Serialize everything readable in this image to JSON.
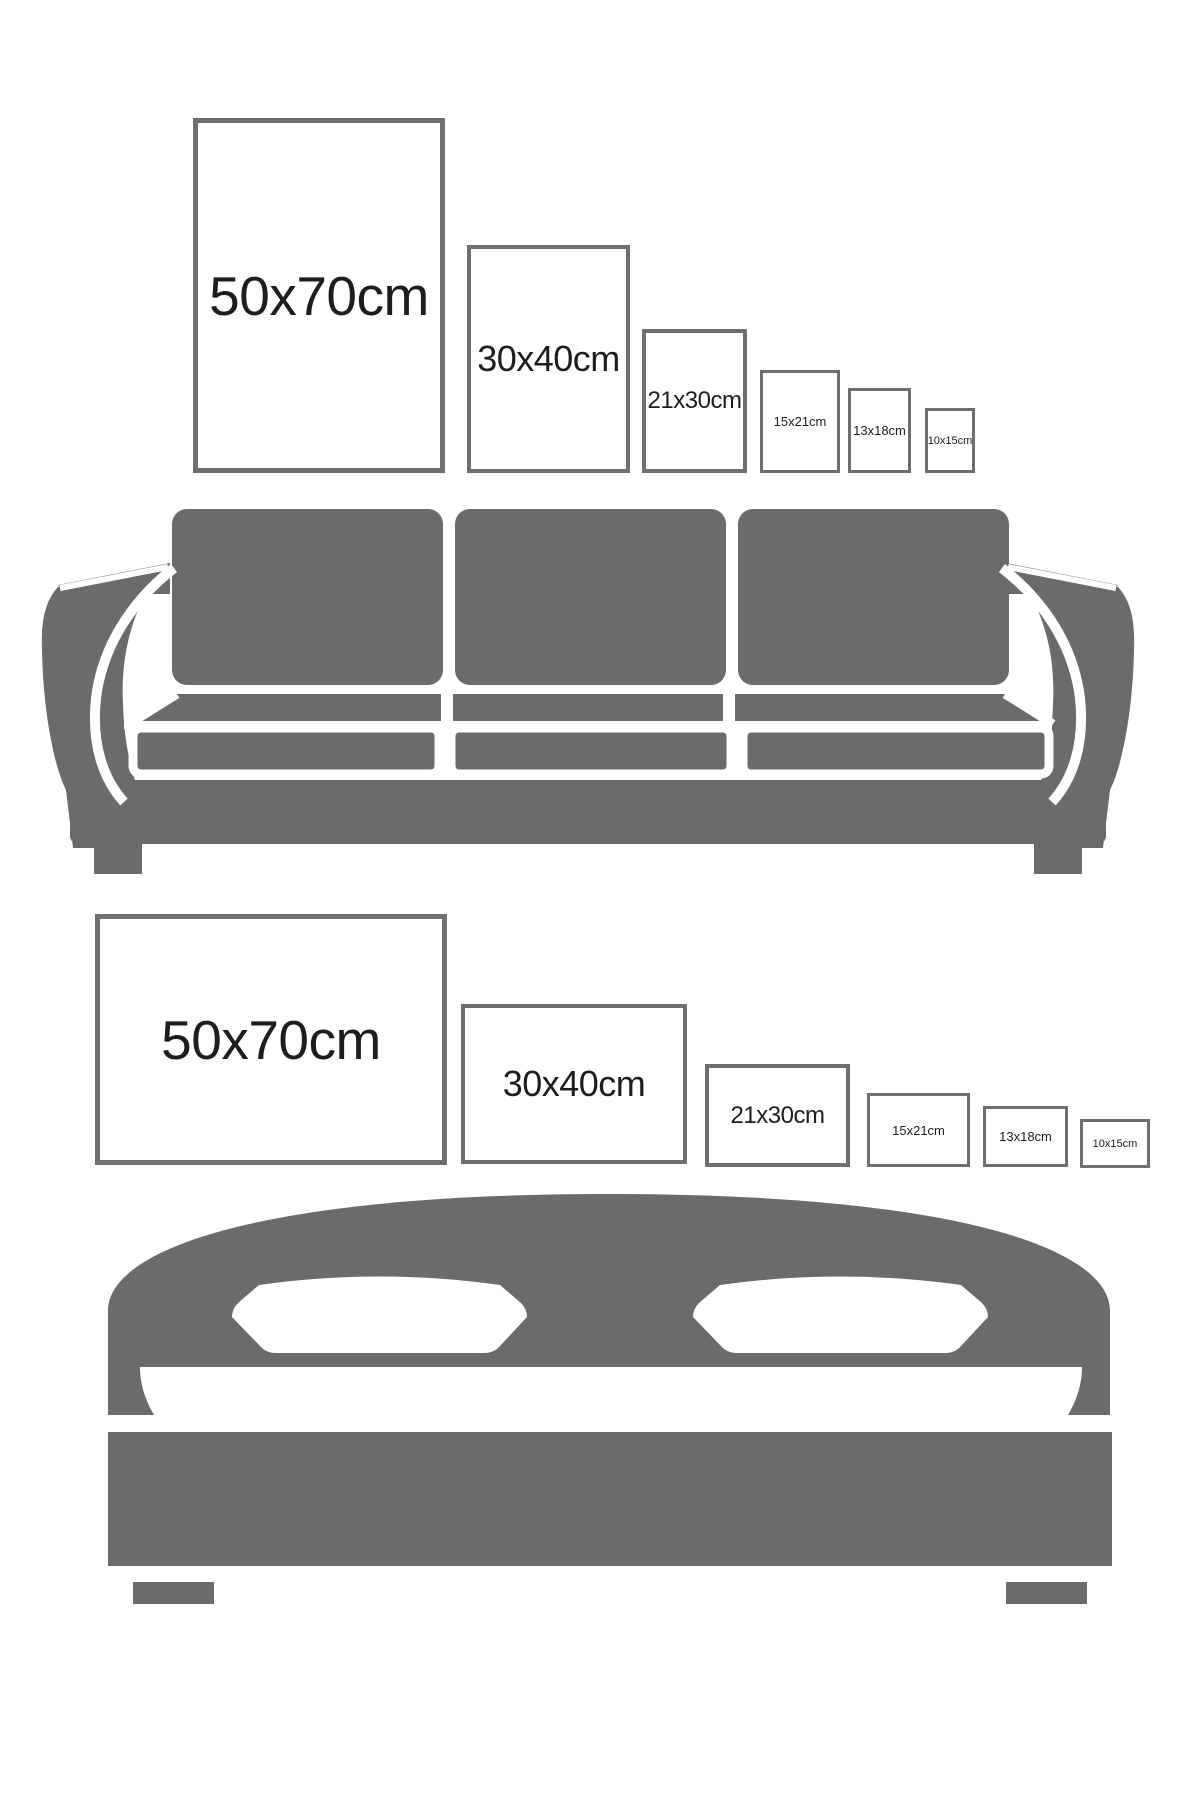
{
  "page": {
    "description": "Picture frame size guide comparing print sizes against a sofa and a bed",
    "background": "#ffffff"
  },
  "colors": {
    "furniture": "#6b6b6b",
    "frame_border": "#6f6f6f",
    "label_text": "#1d1d1d"
  },
  "sofa_section": {
    "illustration": "three-seat sofa silhouette",
    "frames": [
      {
        "label": "50x70cm"
      },
      {
        "label": "30x40cm"
      },
      {
        "label": "21x30cm"
      },
      {
        "label": "15x21cm"
      },
      {
        "label": "13x18cm"
      },
      {
        "label": "10x15cm"
      }
    ]
  },
  "bed_section": {
    "illustration": "double bed silhouette",
    "frames": [
      {
        "label": "50x70cm"
      },
      {
        "label": "30x40cm"
      },
      {
        "label": "21x30cm"
      },
      {
        "label": "15x21cm"
      },
      {
        "label": "13x18cm"
      },
      {
        "label": "10x15cm"
      }
    ]
  }
}
